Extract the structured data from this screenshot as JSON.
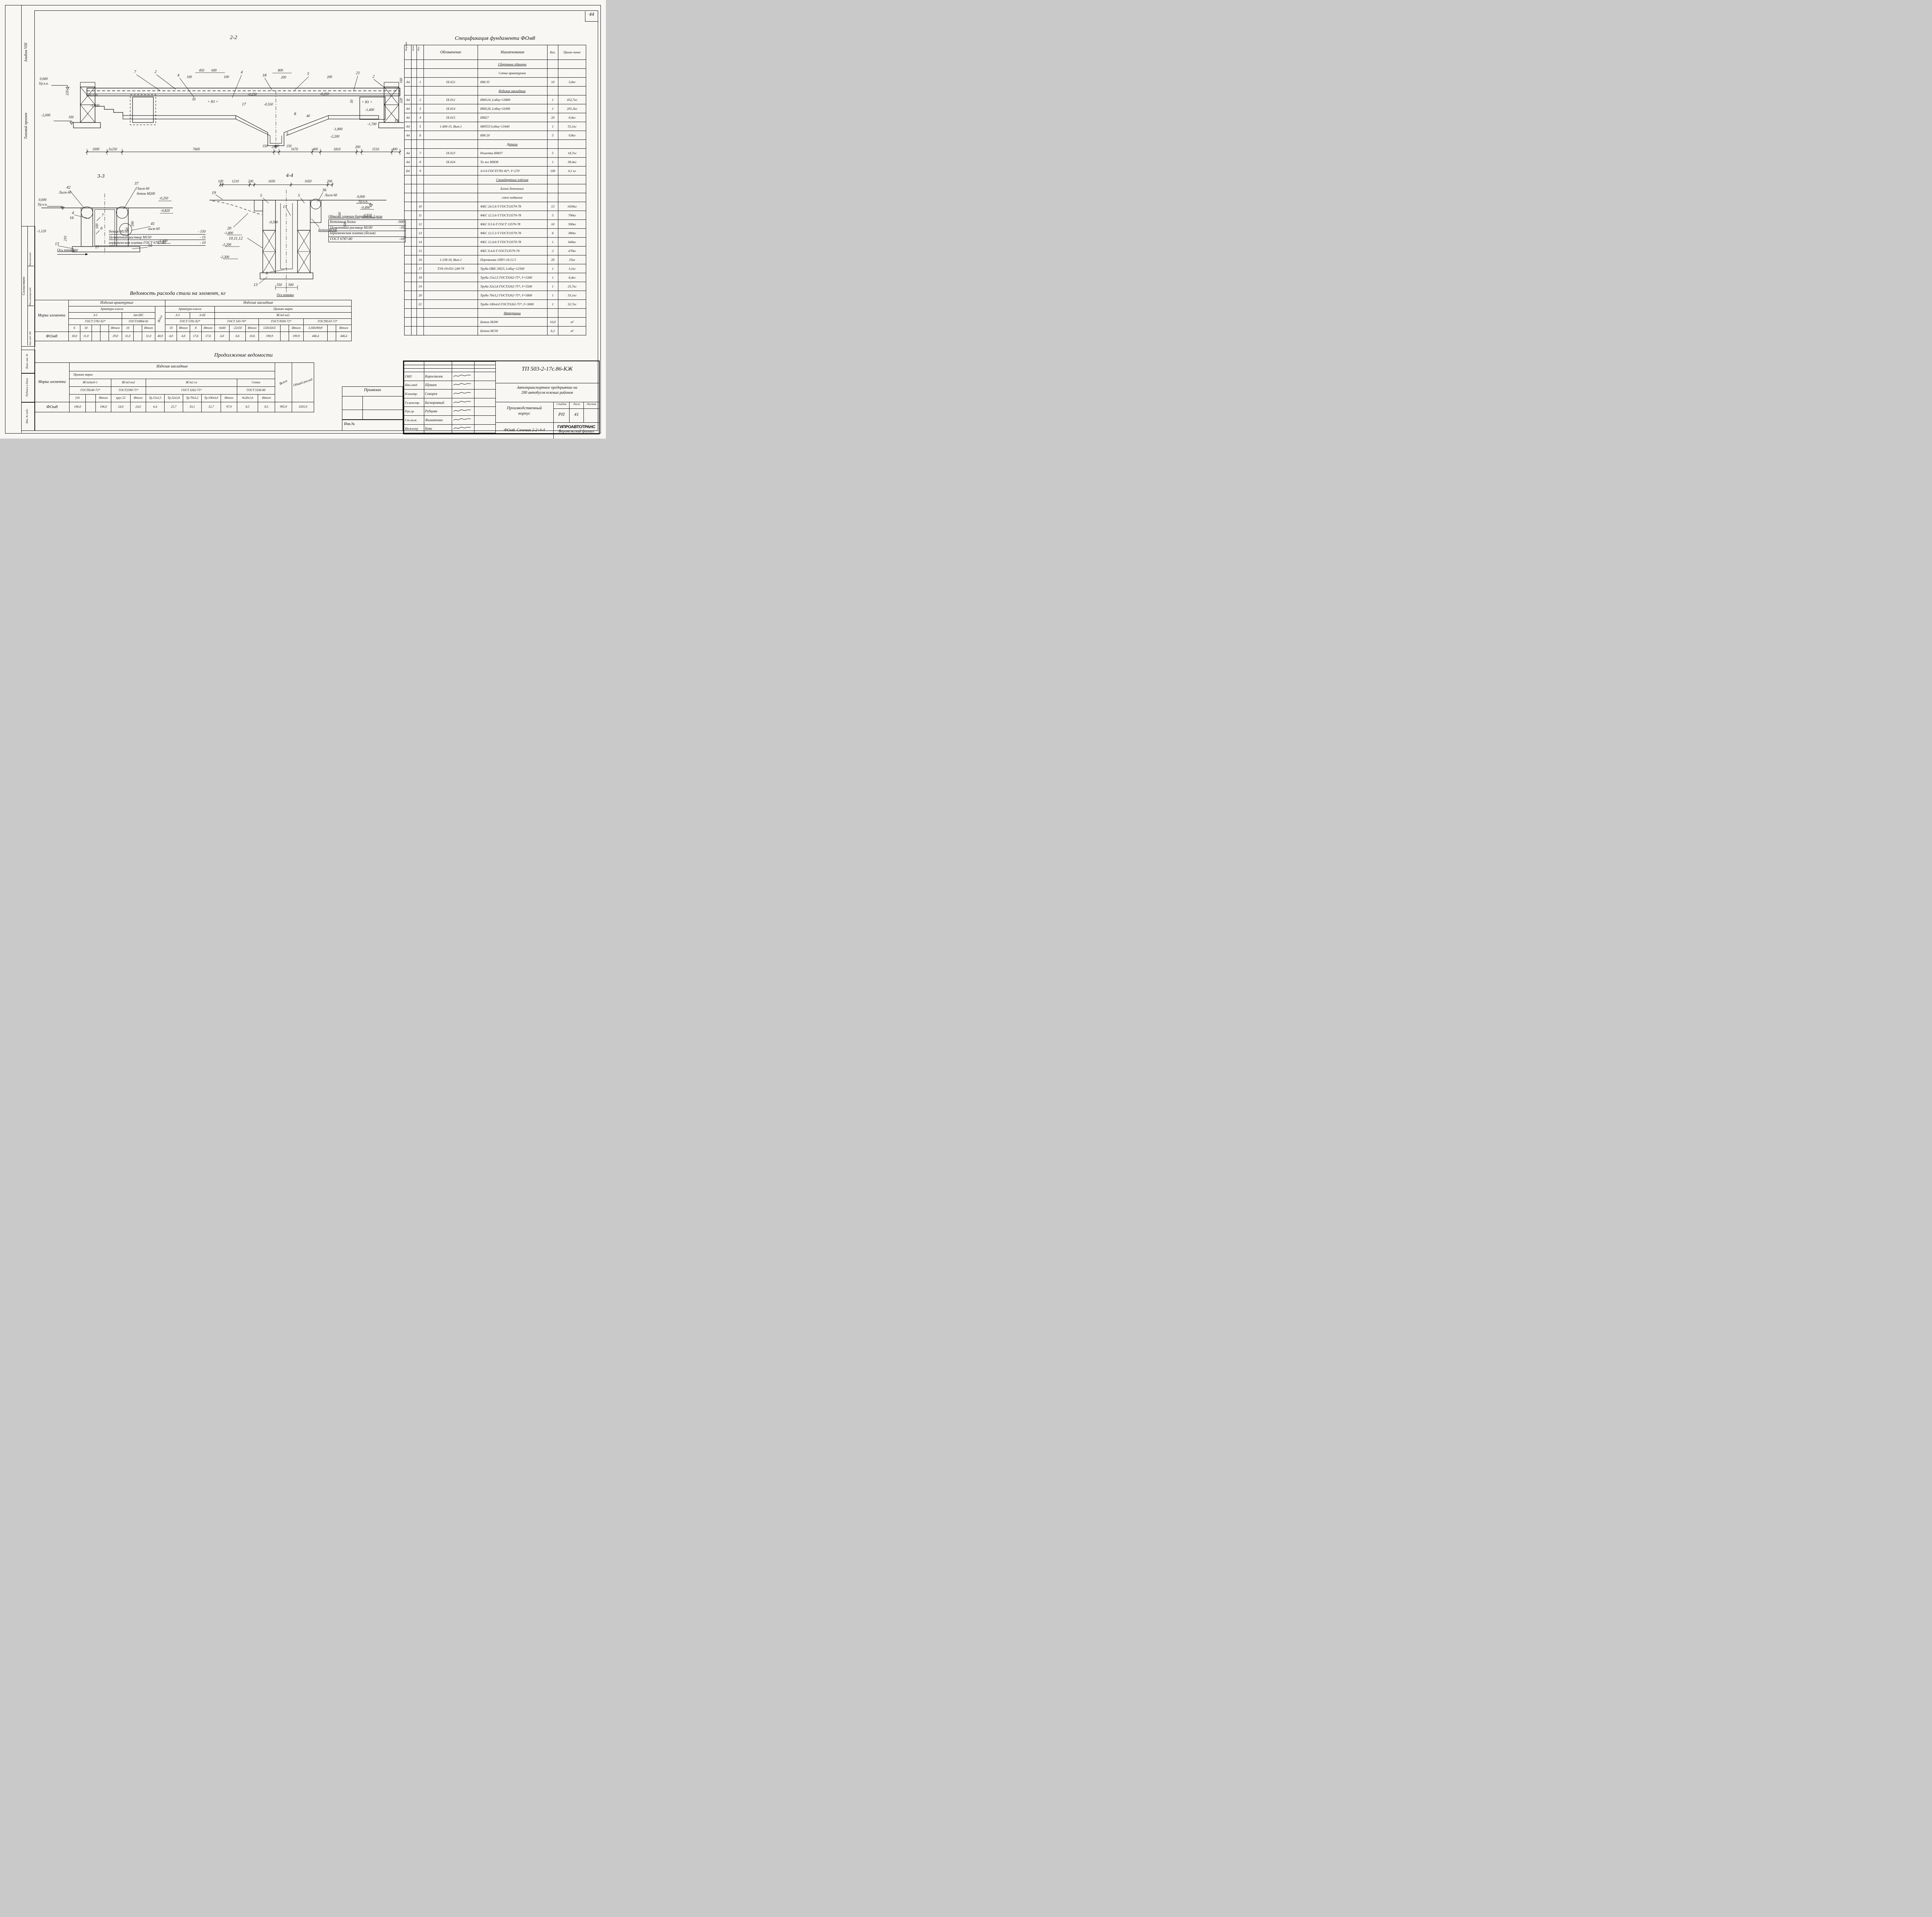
{
  "page": {
    "number": "44"
  },
  "margins": {
    "album": "Альбом VIII",
    "project_type": "Типовой проект",
    "agreed": "Согласовано",
    "agreed_rows": [
      "Нач.отд. ОВ",
      "Нач.электроотд.",
      "Нач.техотд."
    ],
    "vzam_inv": "Взам. инв. №",
    "podpis_data": "Подпись и дата",
    "inv_podl": "Инв. № подл."
  },
  "spec": {
    "title": "Спецификация фундамента ФОм8",
    "headers": {
      "format": "Формат",
      "zona": "Зона",
      "poz": "Поз.",
      "obozn": "Обозначение",
      "naim": "Наименование",
      "kol": "Кол.",
      "prim": "Приме-чание"
    },
    "rows": [
      {
        "naim": "Сборочные единицы",
        "cls": "sec"
      },
      {
        "naim": "Сетка арматурная",
        "cls": "subc"
      },
      {
        "format": "А4",
        "poz": "1",
        "obozn": "IX.022",
        "naim": "ИМ 35",
        "kol": "10",
        "prim": "3,0кг"
      },
      {
        "naim": "Изделия закладные",
        "cls": "sec"
      },
      {
        "format": "А4",
        "poz": "2",
        "obozn": "IX.012",
        "naim": "ИМ124, Lобщ=13800",
        "kol": "1",
        "prim": "452,7кг"
      },
      {
        "format": "А4",
        "poz": "3",
        "obozn": "IX.014",
        "naim": "ИМ126, Lобщ=11000",
        "kol": "1",
        "prim": "201,3кг"
      },
      {
        "format": "А4",
        "poz": "4",
        "obozn": "IX.015",
        "naim": "ИМ27",
        "kol": "20",
        "prim": "0,4кг"
      },
      {
        "format": "А4",
        "poz": "5",
        "obozn": "1.400-15, Вып.1",
        "naim": "МН553 Lобщ=13440",
        "kol": "1",
        "prim": "55,1кг"
      },
      {
        "format": "А4",
        "poz": "6",
        "naim": "ИМ 20",
        "kol": "5",
        "prim": "9,8кг"
      },
      {
        "naim": "Детали",
        "cls": "sec"
      },
      {
        "format": "А4",
        "poz": "7",
        "obozn": "IX.023",
        "naim": "Решетки ИМ37",
        "kol": "5",
        "prim": "18,7кг"
      },
      {
        "format": "А4",
        "poz": "8",
        "obozn": "IX.024",
        "naim": "То же  ИМ38",
        "kol": "1",
        "prim": "38,4кг"
      },
      {
        "format": "Б4",
        "poz": "9",
        "naim": "А-I-6 ГОСТ5781-82*, ℓ=270",
        "kol": "100",
        "prim": "0,1 кг"
      },
      {
        "naim": "Стандартные изделия",
        "cls": "sec"
      },
      {
        "naim": "Блоки бетонные",
        "cls": "subc"
      },
      {
        "naim": "стен подвалов",
        "cls": "subc"
      },
      {
        "poz": "10",
        "naim": "ФБС 24.5.6-Т ГОСТ13579-78",
        "kol": "13",
        "prim": "1630кг"
      },
      {
        "poz": "11",
        "naim": "ФБС 12.5.6-Т ГОСТ13579-78",
        "kol": "5",
        "prim": "790кг"
      },
      {
        "poz": "12",
        "naim": "ФБС 9.5.6-Т ГОСТ 13579-78",
        "kol": "10",
        "prim": "590кг"
      },
      {
        "poz": "13",
        "naim": "ФБС 12.5.3-Т ГОСТ13579-78",
        "kol": "6",
        "prim": "380кг"
      },
      {
        "poz": "14",
        "naim": "ФБС 12.4.6-Т ГОСТ13579-78",
        "kol": "1",
        "prim": "640кг"
      },
      {
        "poz": "15",
        "naim": "ФБС 9.4.6-Т ГОСТ13579-78",
        "kol": "2",
        "prim": "470кг"
      },
      {
        "poz": "16",
        "obozn": "1.138-10, Вып.1",
        "naim": "Перемычка 1ПР1-10.12.5",
        "kol": "20",
        "prim": "25кг"
      },
      {
        "poz": "17",
        "obozn": "ТУ6-19-051-249-79",
        "naim": "Труба ПВХ ЭП25, Lобщ=12500",
        "kol": "1",
        "prim": "3,1кг"
      },
      {
        "poz": "18",
        "naim": "Труба 15х2,5 ГОСТ3262-75*, ℓ=5300",
        "kol": "1",
        "prim": "6,4кг"
      },
      {
        "poz": "19",
        "naim": "Труба 32х2,8 ГОСТ3262-75*, ℓ=5500",
        "kol": "1",
        "prim": "25,7кг"
      },
      {
        "poz": "20",
        "naim": "Труба 70х3,2 ГОСТ3262-75*, ℓ=5800",
        "kol": "1",
        "prim": "33,1кг"
      },
      {
        "poz": "21",
        "naim": "Труба 100х4,0 ГОСТ3262-75*, ℓ=3000",
        "kol": "1",
        "prim": "32,7кг"
      },
      {
        "naim": "Материалы",
        "cls": "sec"
      },
      {
        "naim": "Бетон М200",
        "kol": "10,0",
        "prim": "м³"
      },
      {
        "naim": "Бетон М150",
        "kol": "6,2",
        "prim": "м³"
      }
    ]
  },
  "s22": {
    "title": "2-2",
    "top": [
      "7",
      "2",
      "4",
      "100",
      "450",
      "600",
      "100",
      "4",
      "18",
      "800",
      "200",
      "5",
      "200",
      "21",
      "2"
    ],
    "right": [
      "160",
      "220",
      "15"
    ],
    "left": [
      "0,000",
      "Ур.ч.п.",
      "220",
      "-0,170",
      "-1,400",
      "-2,000",
      "100"
    ],
    "mid": [
      "50",
      "+ Н1 +",
      "17",
      "-0,250",
      "-0,550",
      "-0,250",
      "8",
      "40",
      "50",
      "+ Н1 +",
      "-1,400",
      "-1,700",
      "-1,800",
      "-2,200",
      "5",
      "150",
      "400",
      "150"
    ],
    "chain": [
      "1000",
      "3х250",
      "7600",
      "250",
      "1670",
      "400",
      "1810",
      "260",
      "1510",
      "400"
    ]
  },
  "s33": {
    "title": "3-3",
    "labels": [
      "42",
      "Лист 60",
      "37",
      "Лист 60",
      "бетон М200",
      "0,000",
      "Ур.ч.п.",
      "-0,250",
      "-0,820",
      "4",
      "16",
      "7",
      "6",
      "-1,120",
      "210",
      "13",
      "100",
      "17",
      "10",
      "41",
      "лист 60",
      "-1,400",
      "100",
      "590",
      "50"
    ],
    "notes": [
      [
        "бетон М150",
        "- 150"
      ],
      [
        "Цементный раствор М150",
        "- 15"
      ],
      [
        "керамическая плитка ГОСТ 6787-80",
        "- 10"
      ]
    ],
    "axis": "Ось канавы"
  },
  "s44": {
    "title": "4-4",
    "dims": [
      "100",
      "1210",
      "200",
      "1650",
      "1650",
      "200"
    ],
    "labels": [
      "19",
      "5",
      "5",
      "36",
      "Лист 60",
      "0,000",
      "Ур.ч.п.",
      "-0,490",
      "-0,820",
      "17",
      "-0,590",
      "20",
      "10,11,12",
      "-1,800",
      "-2,200",
      "-2,300",
      "8",
      "13",
      "Бетон М200",
      "60",
      "330",
      "550",
      "500"
    ],
    "axis": "Ось канавы",
    "note_title": "Обмазка горячим битумом за 2 раза",
    "notes": [
      [
        "Бетонные блоки",
        "-500"
      ],
      [
        "Цементный раствор М100",
        "-10"
      ],
      [
        "керамическая плитка (белая)",
        ""
      ],
      [
        "ГОСТ 6787-80",
        "-10"
      ]
    ]
  },
  "vedomost": {
    "title": "Ведомость расхода стали на элемент, кг",
    "mark_h": "Марка элемента",
    "mark": "ФОм8",
    "g1": "Изделия арматурные",
    "g2": "Изделия закладные",
    "arm": "Арматура класса",
    "arm2": "Арматура класса",
    "prokat": "Прокат марки",
    "c_ai": "А-I",
    "c_at": "Ат-IIIС",
    "c_vsego": "Всего",
    "c_ai2": "А-I",
    "c_aiii": "А-III",
    "c_vst": "ВСт3 кп2",
    "g_5781": "ГОСТ 5781-82*",
    "g_10884": "ГОСТ10884-81",
    "g_5781b": "ГОСТ 5781-82*",
    "g_103": "ГОСТ 103-76*",
    "g_8509": "ГОСТ 8509-72*",
    "g_8510": "ГОСТ8510-72*",
    "sizes": [
      "6",
      "10",
      "",
      "",
      "Итого",
      "10",
      "",
      "Итого",
      "10",
      "Итого",
      "8",
      "Итого",
      "-6х60",
      "-22х50",
      "Итого",
      "L50х50х5",
      "",
      "Итого",
      "L160х90х9",
      "",
      "Итого"
    ],
    "values": [
      "18,0",
      "11,0",
      "",
      "",
      "29,0",
      "11,0",
      "",
      "11,0",
      "40,0",
      "4,0",
      "4,0",
      "17,6",
      "17,6",
      "4,0",
      "6,6",
      "10,6",
      "190,9",
      "",
      "190,9",
      "446,4",
      "",
      "446,4"
    ]
  },
  "prod": {
    "title": "Продолжение ведомости",
    "mark_h": "Марка элемента",
    "mark": "ФОм8",
    "g": "Изделия закладные",
    "prokat": "Прокат марки",
    "s1": "ВСт3пс6-1",
    "s2": "ВСт3 кп2",
    "s3": "ВСт2 сп",
    "s4": "Сетки",
    "g1": "ГОСТ8240-72*",
    "g2": "ГОСТ2590-71*",
    "g3": "ГОСТ 3262-75*",
    "g4": "ГОСТ 5336-80",
    "vsego": "Всего",
    "total": "Общий расход",
    "sizes": [
      "[16",
      "",
      "Итого",
      "круг 22",
      "Итого",
      "Тр.15х2,5",
      "Тр.32х2,8",
      "Тр.70х3,2",
      "Тр.100х4,0",
      "Итого",
      "№20х1,6",
      "Итого"
    ],
    "values": [
      "196,0",
      "",
      "196,0",
      "24,0",
      "24,0",
      "6,4",
      "25,7",
      "33,1",
      "32,7",
      "97,9",
      "8,5",
      "8,5",
      "995,9",
      "1035,9"
    ]
  },
  "titleblock": {
    "code": "ТП 503-2-17с.86-КЖ",
    "project1": "Автотранспортное предприятие на",
    "project2": "200 автобусов южных районов",
    "object1": "Производственный",
    "object2": "корпус",
    "stage_h": "Стадия",
    "sheet_h": "Лист",
    "sheets_h": "Листов",
    "stage": "РП",
    "sheet": "41",
    "sheets": "",
    "caption": "ФОм8. Сечения 2-2÷4-4",
    "org": "ГИПРОАВТОТРАНС",
    "org_branch": "Воронежский филиал",
    "staff": [
      [
        "ГИП",
        "Коростелев"
      ],
      [
        "Нач.отд.",
        "Шуваев"
      ],
      [
        "Н.контр.",
        "Сокорев"
      ],
      [
        "Гл.констр.",
        "Бескоровный"
      ],
      [
        "Рук.гр.",
        "Рубцова"
      ],
      [
        "Ст.инж.",
        "Филиппенко"
      ],
      [
        "Инженер",
        "Бова"
      ]
    ],
    "privyazan": "Привязан",
    "inv_no": "Инв.№"
  }
}
